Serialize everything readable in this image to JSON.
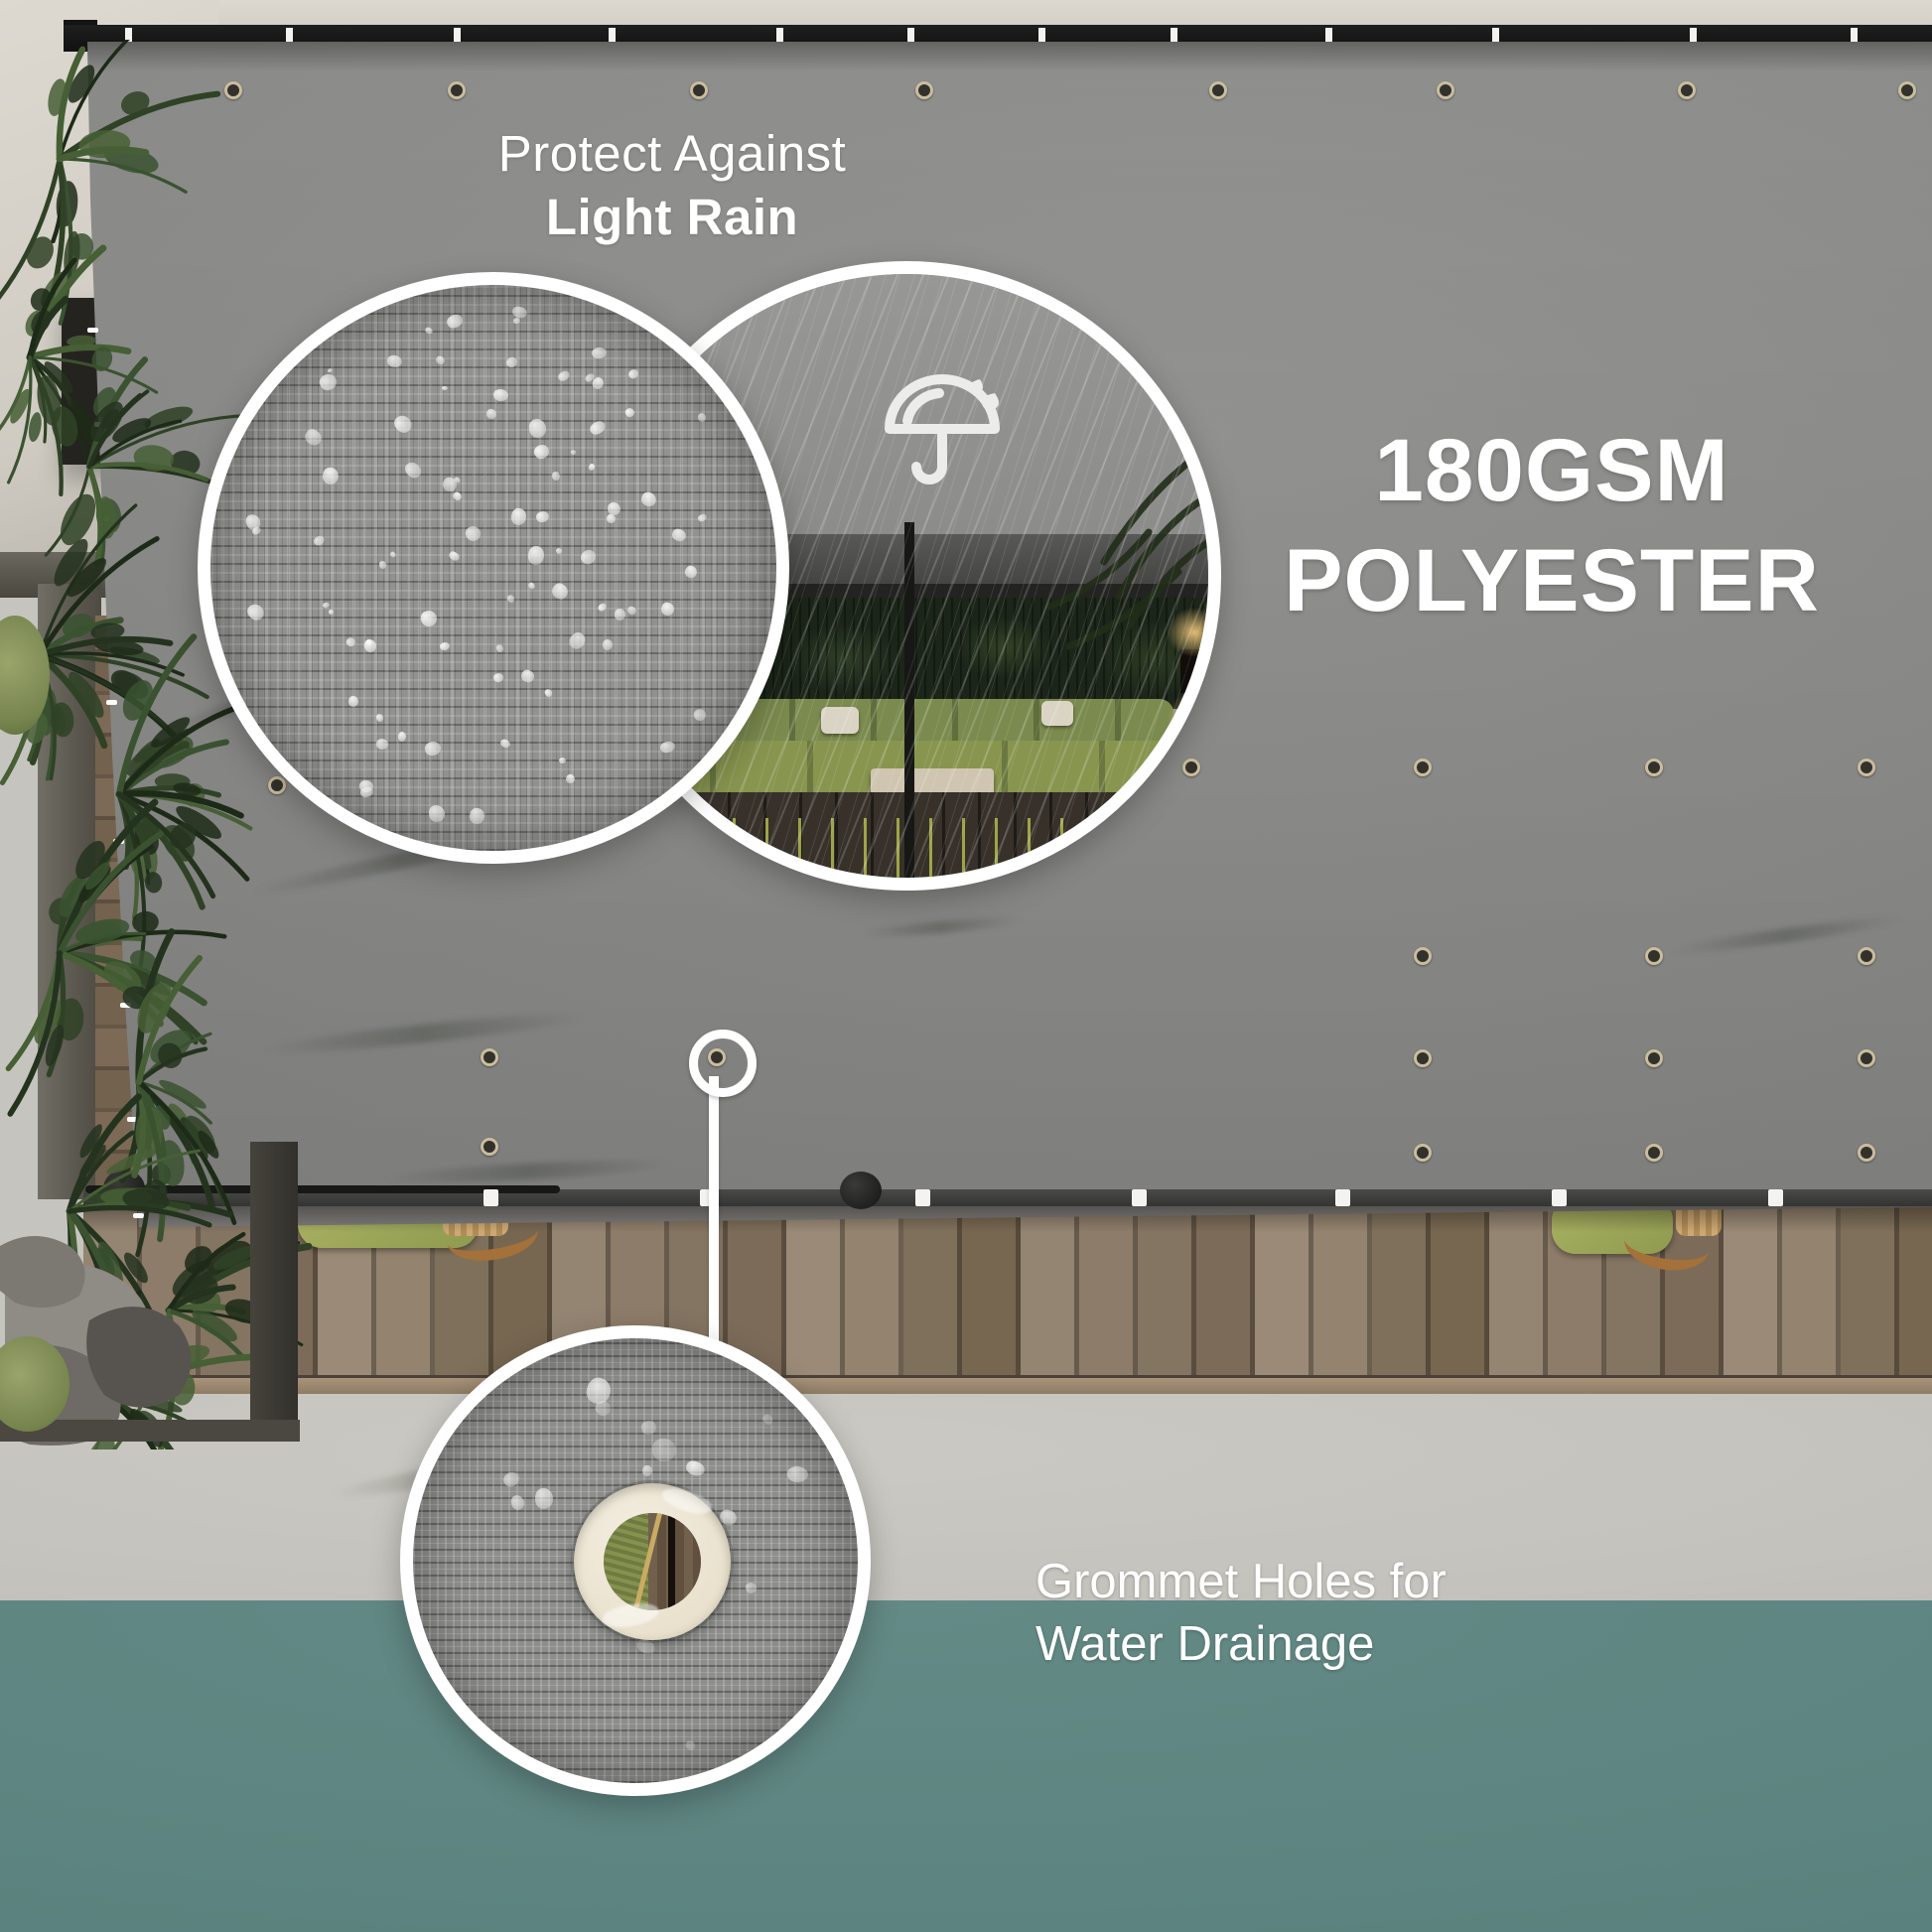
{
  "title": {
    "line1": "Protect Against",
    "line2": "Light Rain"
  },
  "material_label": {
    "line1": "180GSM",
    "line2": "POLYESTER"
  },
  "caption": {
    "line1": "Grommet Holes for",
    "line2": "Water Drainage"
  },
  "icons": {
    "umbrella": "umbrella-rain-icon"
  },
  "colors": {
    "text": "#ffffff",
    "tarp_gray": "#8f8f8d",
    "pool_teal": "#5d8480",
    "concrete": "#c6c4be",
    "deck_wood": "#8b7a69",
    "ring_white": "#ffffff",
    "grommet_cream": "#ece5d3",
    "cushion_green": "#9faa5c"
  }
}
